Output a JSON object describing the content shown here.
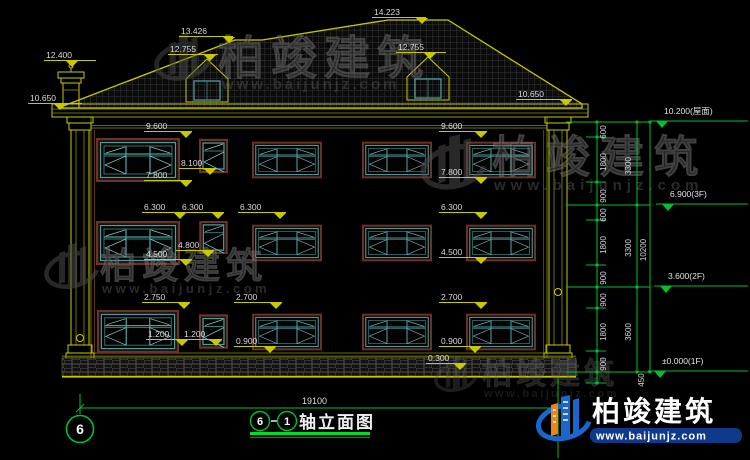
{
  "title": {
    "axis_a": "6",
    "axis_b": "1",
    "text": "轴立面图"
  },
  "axis_bubble": {
    "label": "6"
  },
  "watermark": {
    "name": "柏竣建筑",
    "url": "www.baijunjz.com"
  },
  "brand": {
    "name": "柏竣建筑",
    "url": "www.baijunjz.com"
  },
  "colors": {
    "cad_yellow": "#c9c900",
    "cad_green": "#00c030",
    "dim_text": "#dadada",
    "window_teal": "#4e9c9c",
    "window_trim": "#6b3328",
    "brand_blue": "#1a66cc",
    "brand_orange": "#f0821e"
  },
  "dims": {
    "ridge": "14.223",
    "left_ridge": "13.426",
    "dormer_left": "12.755",
    "dormer_right": "12.755",
    "chimney": "12.400",
    "eave_left": "10.650",
    "eave_right": "10.650",
    "f3_top_left": "9.600",
    "f3_top_right": "9.600",
    "f3_small_top": "8.100",
    "f3_sill_left": "7.800",
    "f3_sill_right": "7.800",
    "f2_top_1": "6.300",
    "f2_top_2": "6.300",
    "f2_top_3": "6.300",
    "f2_top_right": "6.300",
    "f2_small_sill": "4.800",
    "f2_sill_left": "4.500",
    "f2_sill_right": "4.500",
    "f1_top_left": "2.750",
    "f1_top_mid": "2.700",
    "f1_top_right": "2.700",
    "f1_sill_a": "1.200",
    "f1_sill_b": "1.200",
    "f1_sill_mid": "0.900",
    "f1_sill_right": "0.900",
    "plinth_top": "0.300",
    "total_width": "19100"
  },
  "levels": [
    {
      "label": "10.200(屋面)"
    },
    {
      "label": "6.900(3F)"
    },
    {
      "label": "3.600(2F)"
    },
    {
      "label": "±0.000(1F)"
    }
  ],
  "chain": {
    "segments": [
      "600",
      "1800",
      "900",
      "600",
      "1800",
      "900",
      "900",
      "1800",
      "900"
    ],
    "sub_totals": [
      "3300",
      "3300",
      "3600"
    ],
    "total": "10200",
    "below": "450"
  }
}
